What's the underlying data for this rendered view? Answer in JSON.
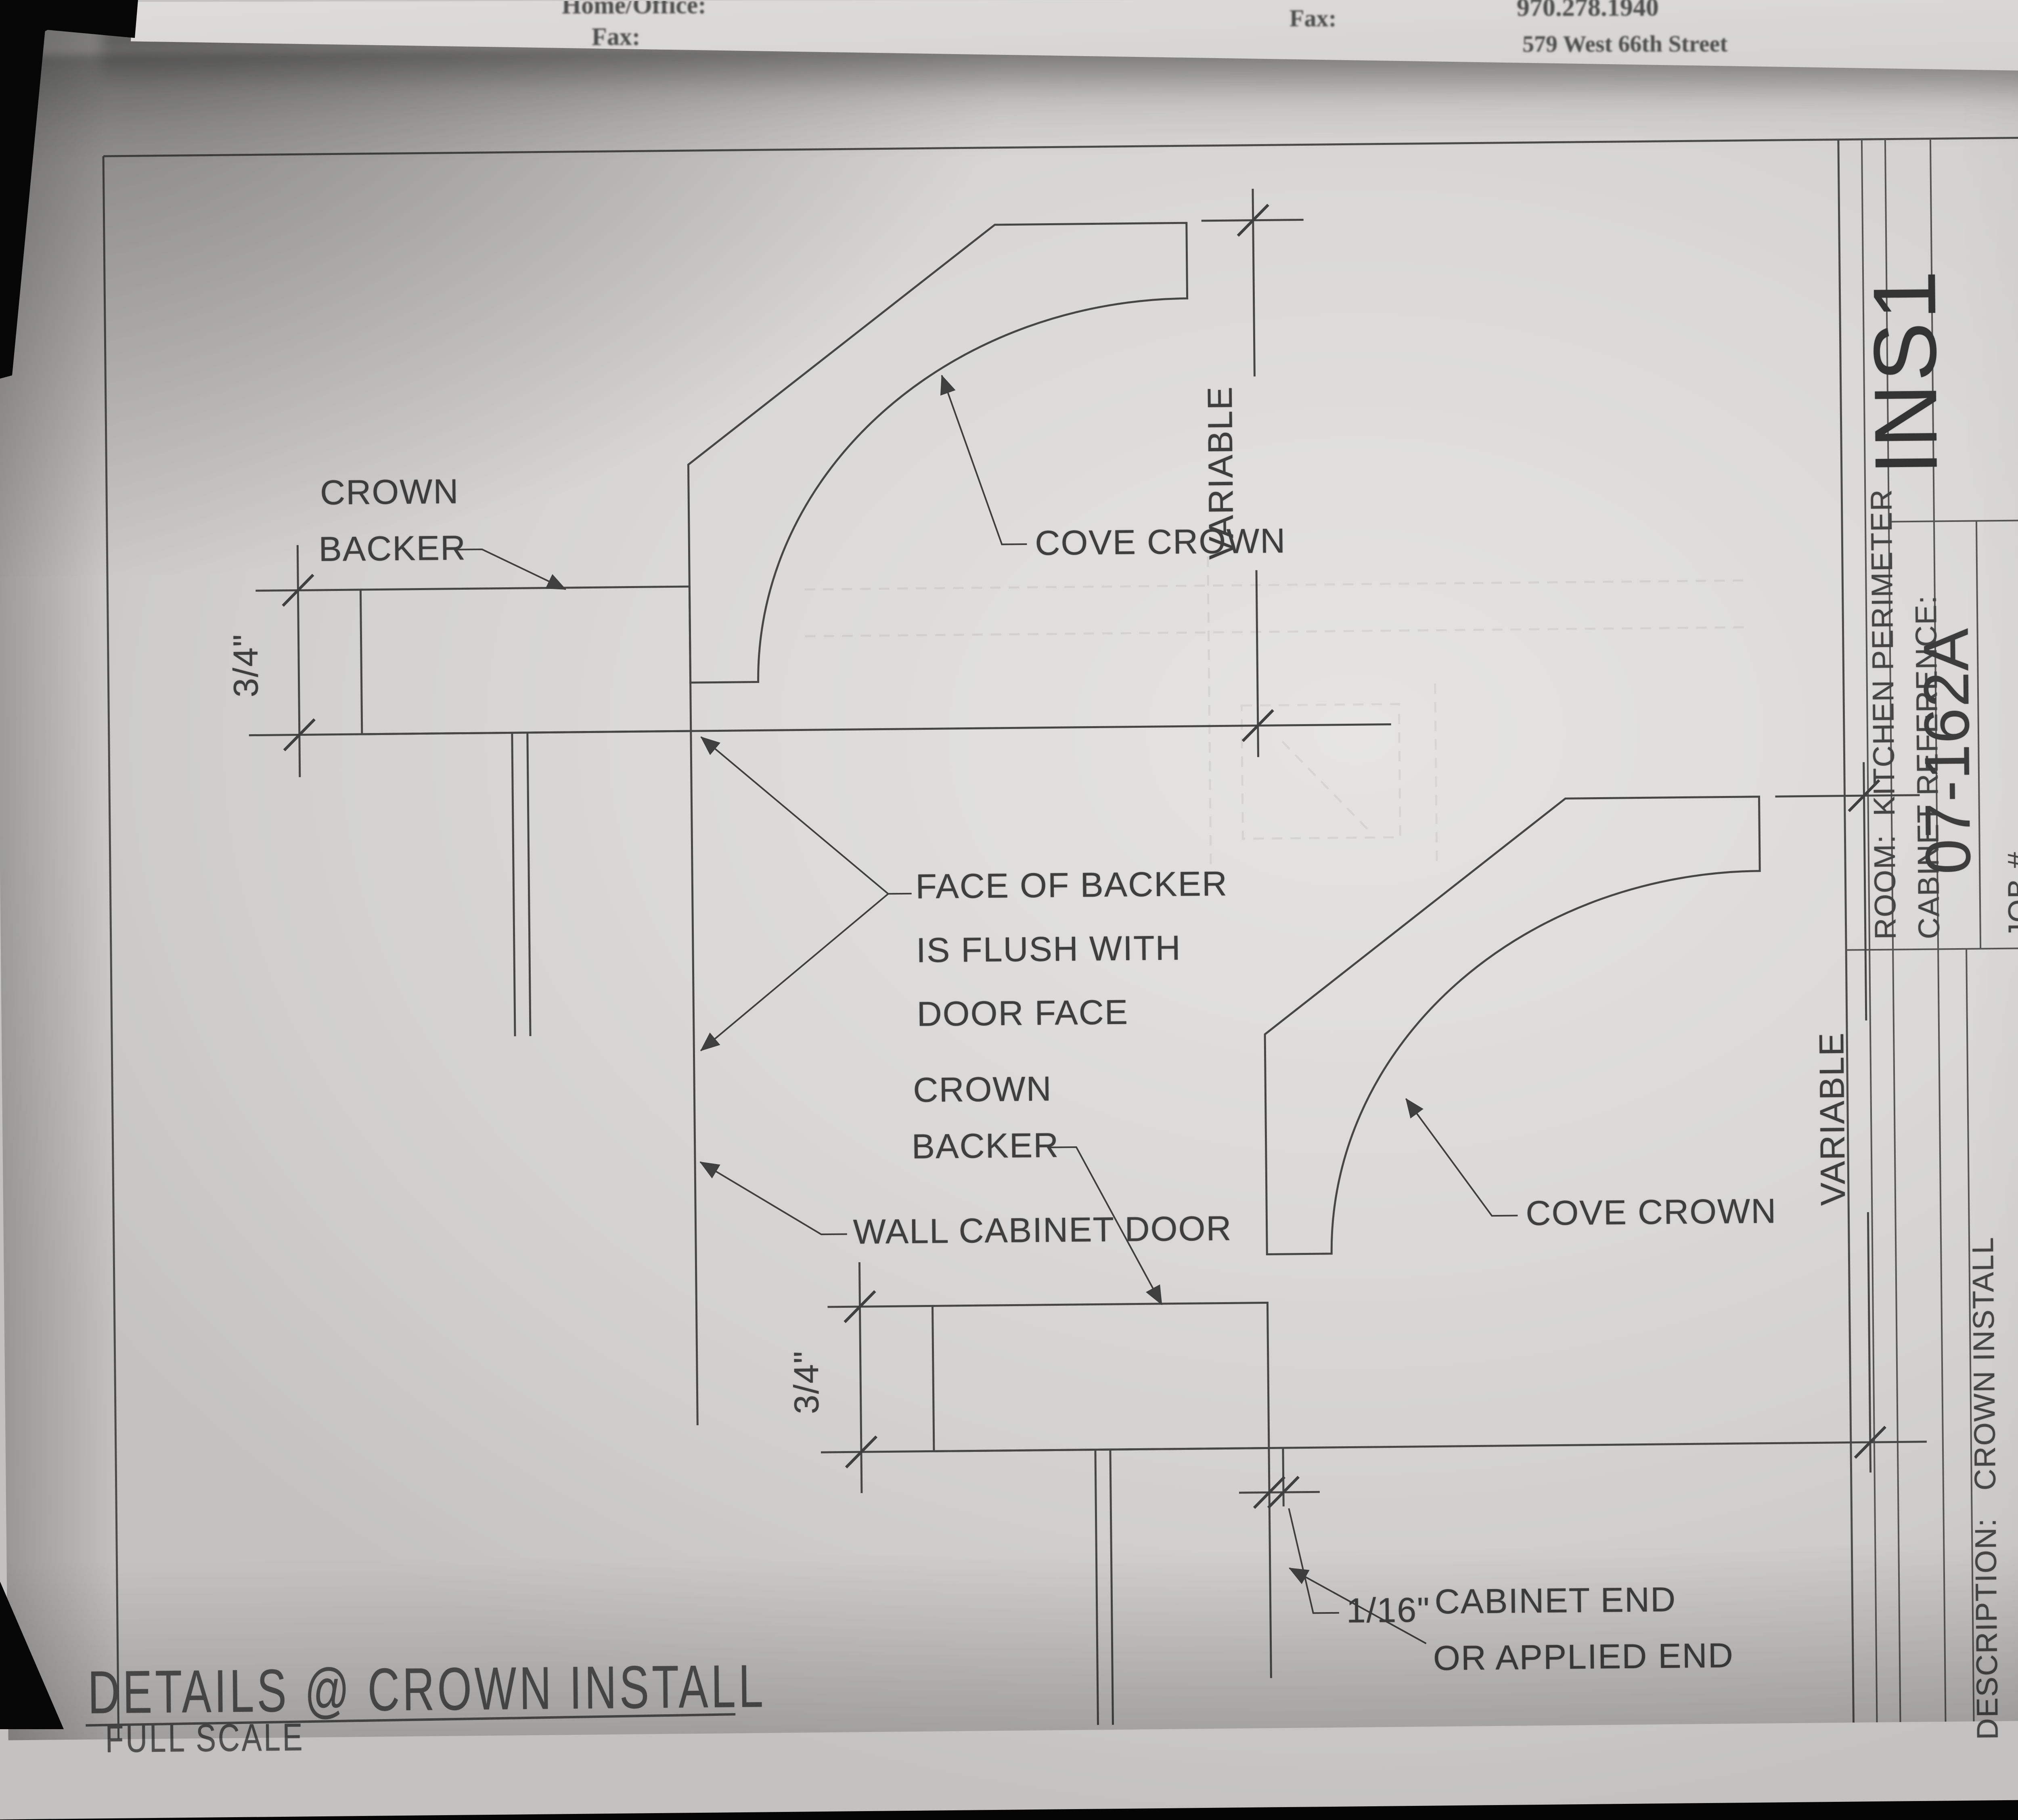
{
  "background_sheet": {
    "home_office_label": "Home/Office:",
    "fax_label_left": "Fax:",
    "fax_label_right": "Fax:",
    "fax_number": "970.278.1940",
    "address": "579 West 66th Street"
  },
  "drawing": {
    "sheet_title": "DETAILS @ CROWN INSTALL",
    "scale_note": "FULL SCALE",
    "annotations": {
      "crown_backer_l1": "CROWN",
      "crown_backer_l2": "BACKER",
      "cove_crown": "COVE CROWN",
      "variable": "VARIABLE",
      "three_quarter": "3/4\"",
      "face_flush_l1": "FACE OF BACKER",
      "face_flush_l2": "IS FLUSH WITH",
      "face_flush_l3": "DOOR FACE",
      "wall_cabinet_door": "WALL CABINET DOOR",
      "sixteenth": "1/16\"",
      "cabinet_end_l1": "CABINET END",
      "cabinet_end_l2": "OR APPLIED END"
    }
  },
  "title_block": {
    "sheet_code": "INS1",
    "date": "1-28-08",
    "room": "ROOM:  KITCHEN PERIMETER",
    "cabinet_reference": "CABINET REFERENCE:",
    "job_number_label": "JOB #",
    "job_number": "07-162A",
    "job_name_label": "JOB NAME:",
    "description": "DESCRIPTION:   CROWN INSTALL",
    "qty_label": "QTY.:",
    "wood": "WOOD:   KNOTTY ALDER",
    "check_cutlist": "PARTS ARE ON CUTLIST",
    "check_specials": "PARTS TO BE CUT IN SPECIALS",
    "check_install_ref": "FOR INSTALLATION REF. ONLY"
  }
}
